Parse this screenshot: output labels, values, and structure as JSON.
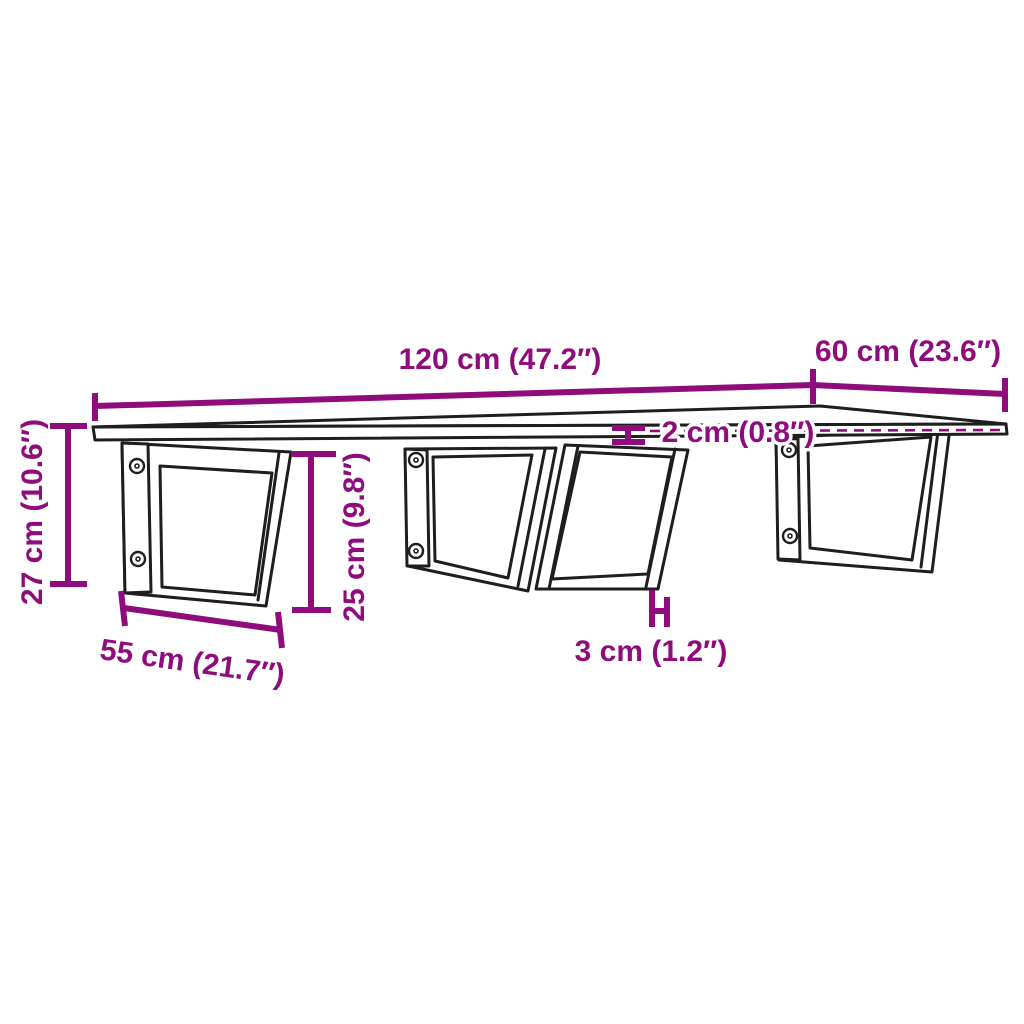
{
  "meta": {
    "background_color": "#ffffff",
    "line_color": "#1e1e1e",
    "accent_color": "#8E0C7C"
  },
  "diagram": {
    "type": "product-dimension-diagram",
    "subject": "wall-mounted shelf board with four trapezoid steel brackets",
    "bracket_count": 4,
    "screw_holes_per_bracket": 2,
    "dimensions": {
      "board_length": {
        "label": "120 cm (47.2″)",
        "value_cm": 120,
        "value_in": 47.2
      },
      "board_depth": {
        "label": "60 cm (23.6″)",
        "value_cm": 60,
        "value_in": 23.6
      },
      "board_thickness": {
        "label": "2 cm (0.8″)",
        "value_cm": 2,
        "value_in": 0.8
      },
      "total_height": {
        "label": "27 cm (10.6″)",
        "value_cm": 27,
        "value_in": 10.6
      },
      "bracket_height": {
        "label": "25 cm (9.8″)",
        "value_cm": 25,
        "value_in": 9.8
      },
      "bracket_depth": {
        "label": "55 cm (21.7″)",
        "value_cm": 55,
        "value_in": 21.7
      },
      "bracket_bar_width": {
        "label": "3 cm (1.2″)",
        "value_cm": 3,
        "value_in": 1.2
      }
    }
  }
}
